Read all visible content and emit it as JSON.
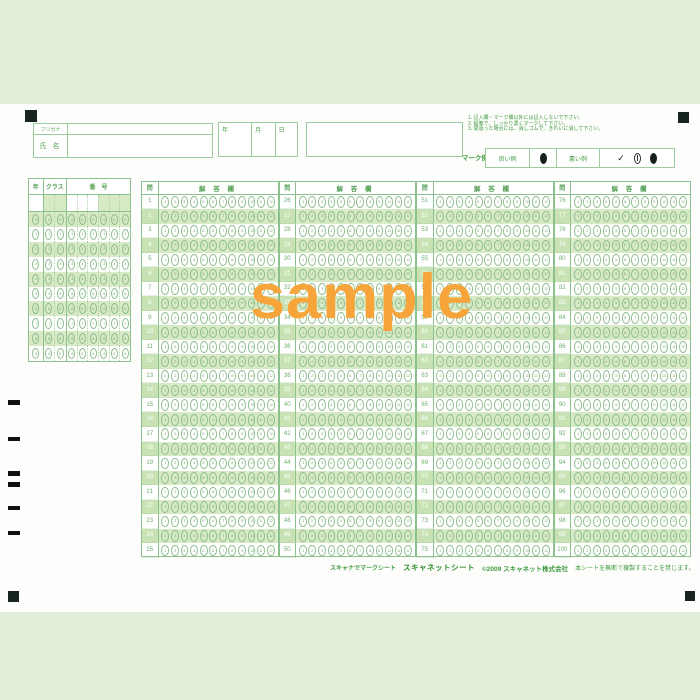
{
  "page": {
    "watermark": "sample"
  },
  "header": {
    "furigana_label": "フリガナ",
    "name_label": "氏 名",
    "date_labels": {
      "year": "年",
      "month": "月",
      "day": "日"
    },
    "instructions": [
      "1. 記入欄・マーク欄以外には記入しないで下さい。",
      "2. 鉛筆で、しっかり濃くマークして下さい。",
      "3. 間違った場合には、消しゴムで、きれいに消して下さい。"
    ],
    "mark_example": {
      "title": "マーク例",
      "good_label": "良い例",
      "bad_label": "悪い例"
    }
  },
  "student_grid": {
    "year_label": "年",
    "class_label": "クラス",
    "number_label": "番　号",
    "digits": [
      0,
      1,
      2,
      3,
      4,
      5,
      6,
      7,
      8,
      9
    ]
  },
  "answer_area": {
    "question_header": "問",
    "answer_header": "解 答 欄",
    "choices": [
      1,
      2,
      3,
      4,
      5,
      6,
      7,
      8,
      9,
      10,
      11,
      12
    ],
    "blocks": [
      {
        "questions": [
          1,
          2,
          3,
          4,
          5,
          6,
          7,
          8,
          9,
          10,
          11,
          12,
          13,
          14,
          15,
          16,
          17,
          18,
          19,
          20,
          21,
          22,
          23,
          24,
          25
        ]
      },
      {
        "questions": [
          26,
          27,
          28,
          29,
          30,
          31,
          32,
          33,
          34,
          35,
          36,
          37,
          38,
          39,
          40,
          41,
          42,
          43,
          44,
          45,
          46,
          47,
          48,
          49,
          50
        ]
      },
      {
        "questions": [
          51,
          52,
          53,
          54,
          55,
          56,
          57,
          58,
          59,
          60,
          61,
          62,
          63,
          64,
          65,
          66,
          67,
          68,
          69,
          70,
          71,
          72,
          73,
          74,
          75
        ]
      },
      {
        "questions": [
          76,
          77,
          78,
          79,
          80,
          81,
          82,
          83,
          84,
          85,
          86,
          87,
          88,
          89,
          90,
          91,
          92,
          93,
          94,
          95,
          96,
          97,
          98,
          99,
          100
        ]
      }
    ]
  },
  "footer": {
    "tagline": "スキャナでマークシート",
    "logo": "スキャネットシート",
    "copyright": "©2009 スキャネット株式会社",
    "notice": "本シートを無断で複製することを禁じます。",
    "model": "SN-0075"
  },
  "colors": {
    "background_green": "#e3efda",
    "sheet_white": "#fdfdfb",
    "grid_green": "#8cc08c",
    "text_green": "#3f9a3f",
    "row_shade": "#d7e9c5",
    "bubble_green": "#74ab74",
    "watermark_orange": "#f7a53a",
    "mark_black": "#16211b"
  }
}
